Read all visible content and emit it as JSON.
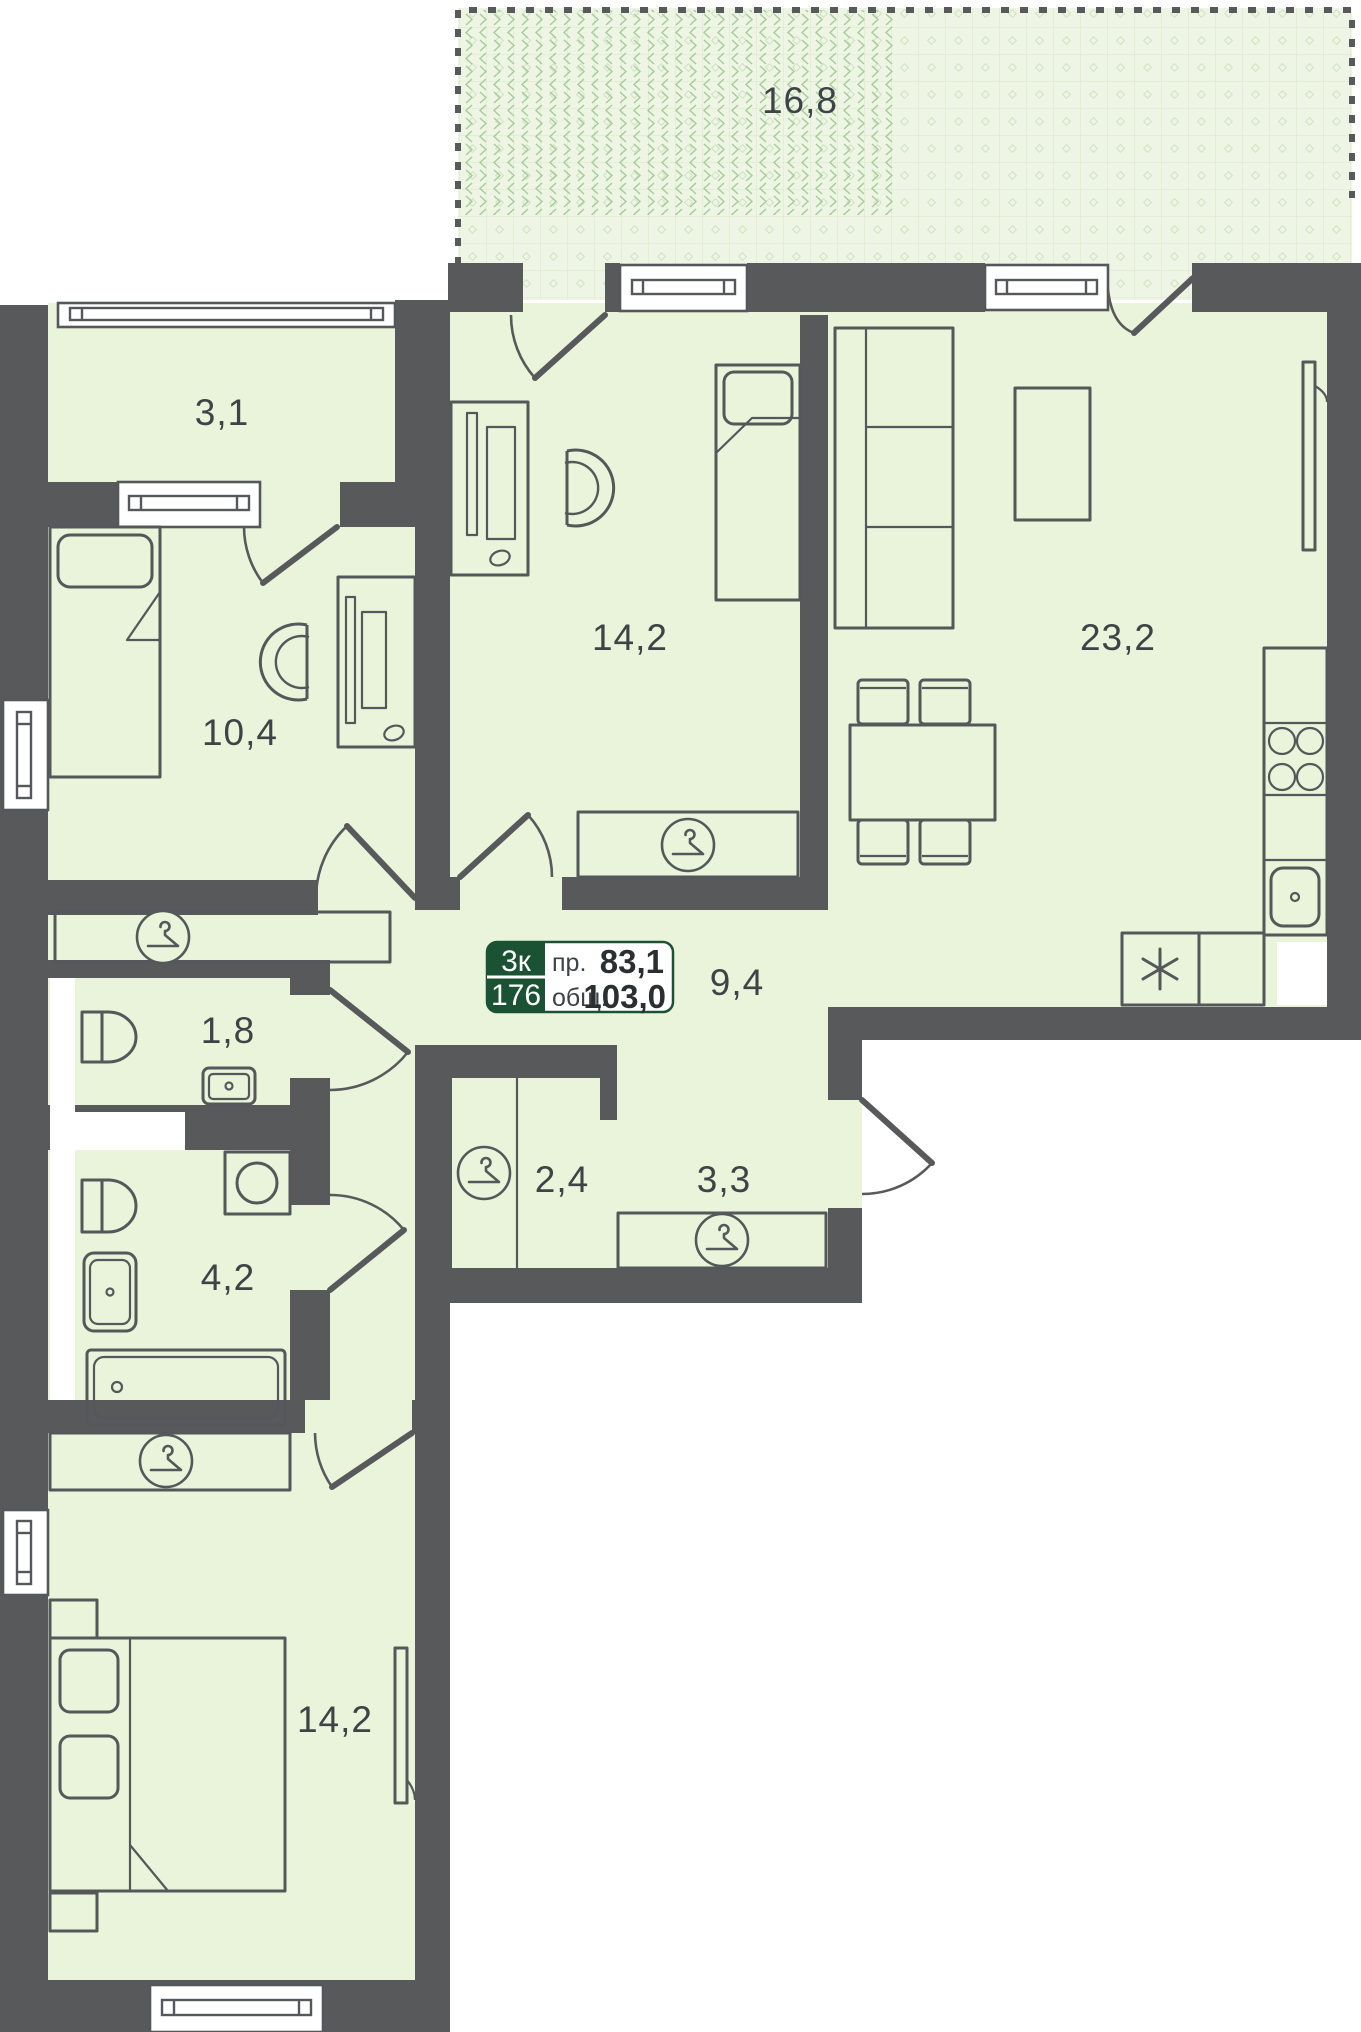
{
  "plan": {
    "colors": {
      "wall": "#58595b",
      "room": "#e9f4db",
      "terrace": "#eef5e4",
      "outline": "#54585a",
      "text": "#3e4347",
      "badge_green": "#1b5233"
    },
    "badge": {
      "rooms": "3к",
      "number": "176",
      "living_label": "пр.",
      "living_value": "83,1",
      "total_label": "общ.",
      "total_value": "103,0"
    },
    "rooms": {
      "terrace": "16,8",
      "balcony": "3,1",
      "bedroom_top": "14,2",
      "living_kitchen": "23,2",
      "bedroom_left": "10,4",
      "hall": "9,4",
      "wc": "1,8",
      "bathroom": "4,2",
      "closet": "2,4",
      "entry_hall": "3,3",
      "bedroom_bottom": "14,2"
    }
  }
}
